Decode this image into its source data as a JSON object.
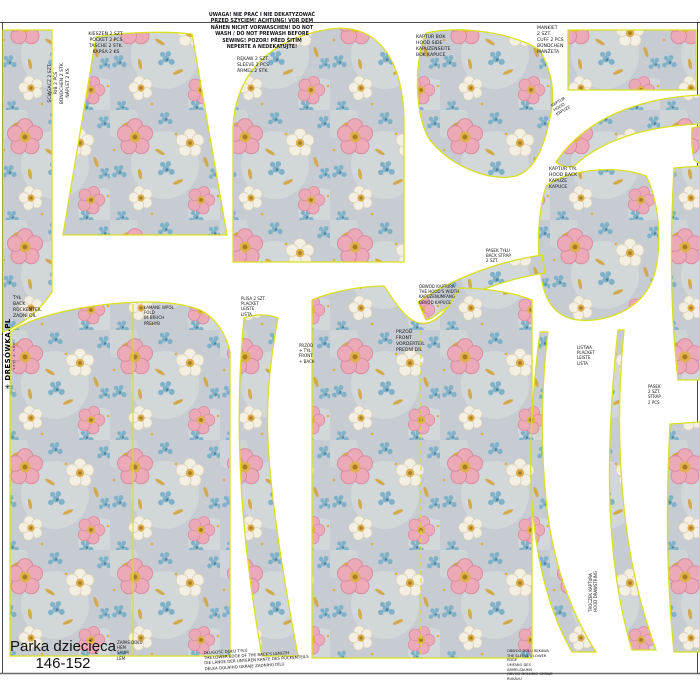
{
  "panel": {
    "size_label": "Parka dziecięca\n146-152",
    "brand": {
      "icon_glyph": "✳",
      "name": "DRESÓWKA.PL",
      "tagline": "szyj z nami"
    },
    "warning": "UWAGA! NIE PRAĆ I NIE DEKATYZOWAĆ\nPRZED SZYCIEM! ACHTUNG! VOR DEM\nNÄHEN NICHT VORWASCHEN! DO NOT\nWASH / DO NOT PREWASH BEFORE\nSEWING! POZOR! PŘED ŠITÍM\nNEPERTE A NEDEKATUJTE!",
    "piece_labels": {
      "rib": "ŚCIĄGACZ 2 SZT.\nRIB 2 PCS\nBÜNDCHEN 2 STK.\nNÁPLET 2 KS",
      "pocket": "KIESZEŃ 2 SZT.\nPOCKET 2 PCS\nTASCHE 2 STK.\nKAPSA 2 KS",
      "sleeve": "RĘKAW 2 SZT.\nSLEEVE 2 PCS\nÄRMEL 2 STK.",
      "hood_side": "KAPTUR BOK\nHOOD SIDE\nKAPUZENSEITE\nBOK KAPUCE",
      "cuff": "MANKIET\n2 SZT.\nCUFF 2 PCS\nBÜNDCHEN\nMANŽETA",
      "hood_strip": "KAPTUR\nHOOD\nKAPUZE",
      "hood_back": "KAPTUR TYŁ\nHOOD BACK\nKAPUZE\nKAPUCE",
      "back": "TYŁ\nBACK\nRÜCKENTEIL\nZADNÍ DÍL",
      "fold": "ŁAMANE WPÓŁ\nFOLD\nIM BRUCH\nPŘEHYB",
      "placket": "PLISA 2 SZT.\nPLACKET\nLEISTE\nLIŠTA",
      "front": "PRZÓD\nFRONT\nVORDERTEIL\nPŘEDNÍ DÍL",
      "front_back": "PRZÓD\n+ TYŁ\nFRONT\n+ BACK",
      "back_strap": "PASEK TYŁU\nBACK STRAP\n2 SZT.",
      "zip_placket": "LISTWA\nPLACKET\nLEISTE\nLIŠTA",
      "strap": "PASEK\n2 SZT.\nSTRAP\n2 PCS",
      "drawstring": "TROCZEK KAPTURA\nHOOD DRAWSTRING"
    },
    "notes": {
      "hood_width": "OBWÓD KAPTURA\nTHE HOOD'S WIDTH\nKAPUZENUMFANG\nOBVOD KAPUCE",
      "hem_small": "ZAPAS DOŁU\nHEM\nSAUM\nLEM",
      "bottom_back": "DŁUGOŚĆ DOŁU TYŁU\nTHE LOWER EDGE OF THE BACK'S LENGTH\nDIE LÄNGE DER UNTEREN KANTE DES RÜCKENTEILS\nDÉLKA DOLNÍHO OKRAJE ZADNÍHO DÍLU",
      "sleeve_edge": "OBWÓD DOŁU RĘKAWA\nTHE SLEEVE'S LOWER EDGE\nUMFANG DES ÄRMELSAUMS\nOBVOD DOLNÍHO OKRAJE RUKÁVU"
    },
    "colors": {
      "cut_line": "#d9e021",
      "frame": "#4a4a4a",
      "fabric_base": "#c6ccd1",
      "pink": "#ecaab8",
      "blue": "#7fb2c8",
      "cream": "#f4efe3",
      "gold": "#ddb04c"
    }
  }
}
